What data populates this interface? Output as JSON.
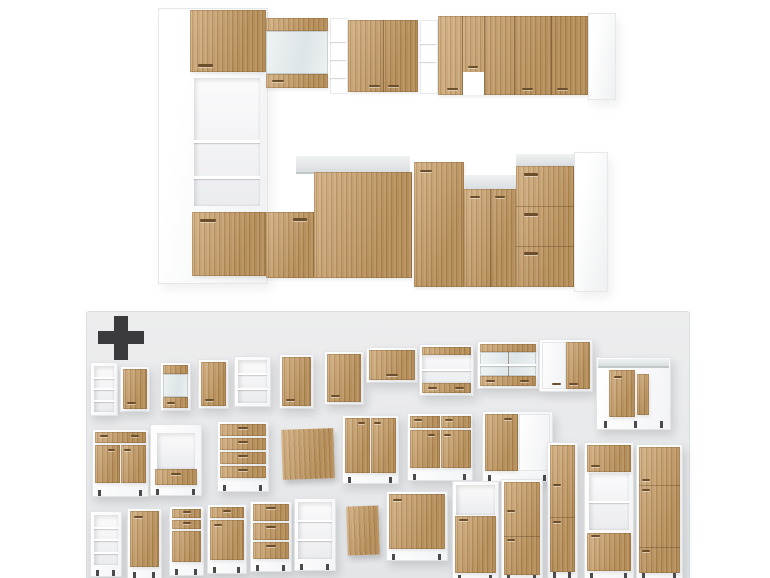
{
  "colors": {
    "background": "#ffffff",
    "panel_bg": "#e9ebee",
    "plus": "#3b3b3d",
    "wood_light": "#cfa977",
    "wood_dark": "#b2884f",
    "carcass_white": "#ffffff",
    "counter_gray": "#dfe3e4",
    "glass_tint": "#e8eef0",
    "handle": "#6b4f2c",
    "leg": "#4b4b4d"
  },
  "plus_icon": {
    "name": "plus-icon"
  },
  "assembled_kitchen": {
    "primitives": [
      {
        "name": "tall-cabinet-carcass",
        "cls": "carcass",
        "x": 158,
        "y": 8,
        "w": 108,
        "h": 274
      },
      {
        "name": "tall-cabinet-upper-door",
        "cls": "wood",
        "x": 190,
        "y": 10,
        "w": 76,
        "h": 62
      },
      {
        "name": "door-handle",
        "cls": "handle",
        "x": 198,
        "y": 64,
        "w": 15,
        "h": 3
      },
      {
        "name": "tall-cabinet-niche",
        "cls": "niche",
        "x": 194,
        "y": 78,
        "w": 66,
        "h": 128
      },
      {
        "name": "niche-shelf",
        "cls": "shelf",
        "x": 194,
        "y": 140,
        "w": 66,
        "h": 3
      },
      {
        "name": "niche-shelf",
        "cls": "shelf",
        "x": 194,
        "y": 176,
        "w": 66,
        "h": 3
      },
      {
        "name": "tall-cabinet-lower-front",
        "cls": "wood",
        "x": 192,
        "y": 212,
        "w": 74,
        "h": 64
      },
      {
        "name": "drawer-handle",
        "cls": "handle",
        "x": 200,
        "y": 219,
        "w": 16,
        "h": 3
      },
      {
        "name": "glass-wall-cabinet-top-strip",
        "cls": "wood",
        "x": 266,
        "y": 18,
        "w": 62,
        "h": 13
      },
      {
        "name": "glass-wall-cabinet-pane",
        "cls": "glass",
        "x": 266,
        "y": 31,
        "w": 62,
        "h": 43
      },
      {
        "name": "glass-wall-cabinet-bottom-strip",
        "cls": "wood",
        "x": 266,
        "y": 74,
        "w": 62,
        "h": 14
      },
      {
        "name": "door-handle",
        "cls": "handle",
        "x": 272,
        "y": 80,
        "w": 12,
        "h": 2
      },
      {
        "name": "open-shelf-column",
        "cls": "shelfcol",
        "x": 330,
        "y": 18,
        "w": 16,
        "h": 74
      },
      {
        "name": "shelf",
        "cls": "shelf",
        "x": 330,
        "y": 40,
        "w": 16,
        "h": 2
      },
      {
        "name": "shelf",
        "cls": "shelf",
        "x": 330,
        "y": 58,
        "w": 16,
        "h": 2
      },
      {
        "name": "shelf",
        "cls": "shelf",
        "x": 330,
        "y": 76,
        "w": 16,
        "h": 2
      },
      {
        "name": "wall-cabinet-double-door",
        "cls": "wood",
        "x": 348,
        "y": 20,
        "w": 70,
        "h": 72
      },
      {
        "name": "door-seam",
        "cls": "seam",
        "x": 383,
        "y": 20,
        "w": 1,
        "h": 72
      },
      {
        "name": "door-handle",
        "cls": "handle",
        "x": 369,
        "y": 85,
        "w": 11,
        "h": 2
      },
      {
        "name": "door-handle",
        "cls": "handle",
        "x": 388,
        "y": 85,
        "w": 11,
        "h": 2
      },
      {
        "name": "open-shelf-column",
        "cls": "shelfcol",
        "x": 420,
        "y": 20,
        "w": 16,
        "h": 72
      },
      {
        "name": "shelf",
        "cls": "shelf",
        "x": 420,
        "y": 42,
        "w": 16,
        "h": 2
      },
      {
        "name": "shelf",
        "cls": "shelf",
        "x": 420,
        "y": 60,
        "w": 16,
        "h": 2
      },
      {
        "name": "corner-wall-cabinet-run",
        "cls": "wood",
        "x": 438,
        "y": 16,
        "w": 150,
        "h": 79
      },
      {
        "name": "door-seam",
        "cls": "seam",
        "x": 462,
        "y": 16,
        "w": 1,
        "h": 79
      },
      {
        "name": "door-seam",
        "cls": "seam",
        "x": 484,
        "y": 16,
        "w": 1,
        "h": 79
      },
      {
        "name": "door-seam",
        "cls": "seam",
        "x": 514,
        "y": 16,
        "w": 1,
        "h": 79
      },
      {
        "name": "door-seam",
        "cls": "seam",
        "x": 551,
        "y": 16,
        "w": 1,
        "h": 79
      },
      {
        "name": "hood-recess",
        "cls": "gap",
        "x": 463,
        "y": 72,
        "w": 21,
        "h": 23
      },
      {
        "name": "door-handle",
        "cls": "handle",
        "x": 447,
        "y": 88,
        "w": 11,
        "h": 2
      },
      {
        "name": "door-handle",
        "cls": "handle",
        "x": 468,
        "y": 66,
        "w": 10,
        "h": 2
      },
      {
        "name": "door-handle",
        "cls": "handle",
        "x": 522,
        "y": 88,
        "w": 11,
        "h": 2
      },
      {
        "name": "door-handle",
        "cls": "handle",
        "x": 557,
        "y": 88,
        "w": 11,
        "h": 2
      },
      {
        "name": "wall-run-end-panel",
        "cls": "carcass",
        "x": 588,
        "y": 13,
        "w": 26,
        "h": 85
      },
      {
        "name": "left-base-cabinet-front",
        "cls": "wood",
        "x": 266,
        "y": 212,
        "w": 48,
        "h": 66
      },
      {
        "name": "drawer-handle",
        "cls": "handle",
        "x": 293,
        "y": 218,
        "w": 14,
        "h": 3
      },
      {
        "name": "corner-countertop",
        "cls": "counter",
        "x": 296,
        "y": 156,
        "w": 114,
        "h": 16
      },
      {
        "name": "corner-base-cabinet",
        "cls": "wood",
        "x": 314,
        "y": 172,
        "w": 98,
        "h": 106
      },
      {
        "name": "right-base-cabinet",
        "cls": "wood",
        "x": 414,
        "y": 162,
        "w": 50,
        "h": 125
      },
      {
        "name": "door-handle",
        "cls": "handle",
        "x": 420,
        "y": 170,
        "w": 12,
        "h": 2
      },
      {
        "name": "right-countertop",
        "cls": "counter",
        "x": 464,
        "y": 175,
        "w": 52,
        "h": 14
      },
      {
        "name": "right-base-cabinets",
        "cls": "wood",
        "x": 464,
        "y": 189,
        "w": 52,
        "h": 98
      },
      {
        "name": "door-seam",
        "cls": "seam",
        "x": 490,
        "y": 189,
        "w": 1,
        "h": 98
      },
      {
        "name": "door-handle",
        "cls": "handle",
        "x": 470,
        "y": 196,
        "w": 10,
        "h": 2
      },
      {
        "name": "door-handle",
        "cls": "handle",
        "x": 495,
        "y": 196,
        "w": 10,
        "h": 2
      },
      {
        "name": "drawer-unit-countertop",
        "cls": "counter",
        "x": 516,
        "y": 154,
        "w": 58,
        "h": 12
      },
      {
        "name": "drawer-base-unit",
        "cls": "wood",
        "x": 516,
        "y": 166,
        "w": 58,
        "h": 121
      },
      {
        "name": "drawer-seam",
        "cls": "seamh",
        "x": 516,
        "y": 206,
        "w": 58,
        "h": 1
      },
      {
        "name": "drawer-seam",
        "cls": "seamh",
        "x": 516,
        "y": 246,
        "w": 58,
        "h": 1
      },
      {
        "name": "drawer-handle",
        "cls": "handle",
        "x": 524,
        "y": 173,
        "w": 14,
        "h": 3
      },
      {
        "name": "drawer-handle",
        "cls": "handle",
        "x": 524,
        "y": 213,
        "w": 14,
        "h": 3
      },
      {
        "name": "drawer-handle",
        "cls": "handle",
        "x": 524,
        "y": 252,
        "w": 14,
        "h": 3
      },
      {
        "name": "base-run-end-panel",
        "cls": "carcass",
        "x": 574,
        "y": 152,
        "w": 32,
        "h": 138
      }
    ]
  },
  "module_panel": {
    "x": 86,
    "y": 311,
    "w": 602,
    "h": 267,
    "modules": [
      {
        "name": "wall-open-shelf-unit",
        "kind": "open-shelves",
        "x": 3,
        "y": 50,
        "w": 26,
        "h": 52,
        "shelves": 4
      },
      {
        "name": "wall-cabinet-door",
        "kind": "door",
        "x": 33,
        "y": 54,
        "w": 28,
        "h": 44
      },
      {
        "name": "wall-cabinet-glass",
        "kind": "glass",
        "x": 73,
        "y": 50,
        "w": 29,
        "h": 47
      },
      {
        "name": "wall-cabinet-door",
        "kind": "door",
        "x": 111,
        "y": 47,
        "w": 29,
        "h": 48
      },
      {
        "name": "wall-open-shelf-unit",
        "kind": "open-shelves",
        "x": 147,
        "y": 44,
        "w": 35,
        "h": 49,
        "shelves": 3
      },
      {
        "name": "wall-cabinet-door",
        "kind": "door",
        "x": 192,
        "y": 42,
        "w": 33,
        "h": 53
      },
      {
        "name": "wall-cabinet-door",
        "kind": "door",
        "x": 237,
        "y": 39,
        "w": 38,
        "h": 52
      },
      {
        "name": "hood-wall-cabinet",
        "kind": "door-wide",
        "x": 279,
        "y": 35,
        "w": 50,
        "h": 34
      },
      {
        "name": "wall-cabinet-open-wide",
        "kind": "glass-wide-open",
        "x": 332,
        "y": 32,
        "w": 53,
        "h": 50
      },
      {
        "name": "wall-cabinet-glass-wide",
        "kind": "glass-wide",
        "x": 390,
        "y": 29,
        "w": 60,
        "h": 46
      },
      {
        "name": "wall-cabinet-mixed-doors",
        "kind": "two-door-mixed",
        "x": 452,
        "y": 27,
        "w": 52,
        "h": 51
      },
      {
        "name": "corner-base-cabinet",
        "kind": "corner-base",
        "x": 509,
        "y": 45,
        "w": 73,
        "h": 71
      },
      {
        "name": "base-cabinet-drawer-two-doors",
        "kind": "base-2door-drawer",
        "x": 5,
        "y": 117,
        "w": 55,
        "h": 66
      },
      {
        "name": "oven-housing-cabinet",
        "kind": "oven-base",
        "x": 63,
        "y": 112,
        "w": 50,
        "h": 70
      },
      {
        "name": "drawer-base-cabinet",
        "kind": "base-drawers",
        "x": 130,
        "y": 109,
        "w": 50,
        "h": 69,
        "drawers": 4
      },
      {
        "name": "appliance-front-panel",
        "kind": "panel",
        "x": 195,
        "y": 117,
        "w": 52,
        "h": 50
      },
      {
        "name": "base-cabinet-two-doors",
        "kind": "base-2door",
        "x": 255,
        "y": 103,
        "w": 55,
        "h": 67
      },
      {
        "name": "base-cabinet-two-doors-two-drawers",
        "kind": "base-2door-2drawer",
        "x": 320,
        "y": 101,
        "w": 64,
        "h": 66
      },
      {
        "name": "base-cabinet-mixed-doors",
        "kind": "base-2door-mixed",
        "x": 395,
        "y": 99,
        "w": 69,
        "h": 69
      },
      {
        "name": "tall-pantry-cabinet",
        "kind": "tall-pantry",
        "x": 460,
        "y": 130,
        "w": 29,
        "h": 135
      },
      {
        "name": "tall-oven-housing",
        "kind": "tall-oven",
        "x": 497,
        "y": 130,
        "w": 48,
        "h": 136
      },
      {
        "name": "tall-fridge-housing",
        "kind": "tall-fridge",
        "x": 549,
        "y": 132,
        "w": 45,
        "h": 134
      },
      {
        "name": "open-shelf-base-unit",
        "kind": "open-shelves-base",
        "x": 3,
        "y": 199,
        "w": 30,
        "h": 64,
        "shelves": 4
      },
      {
        "name": "base-cabinet-door",
        "kind": "base-door",
        "x": 40,
        "y": 196,
        "w": 33,
        "h": 69
      },
      {
        "name": "base-cabinet-two-drawers-door",
        "kind": "base-2drawer-door",
        "x": 82,
        "y": 194,
        "w": 33,
        "h": 68
      },
      {
        "name": "base-cabinet-drawer-door",
        "kind": "base-drawer-door",
        "x": 120,
        "y": 192,
        "w": 38,
        "h": 68
      },
      {
        "name": "drawer-base-cabinet",
        "kind": "base-drawers",
        "x": 163,
        "y": 189,
        "w": 40,
        "h": 69,
        "drawers": 3
      },
      {
        "name": "open-shelf-base-unit",
        "kind": "open-shelves-base",
        "x": 207,
        "y": 186,
        "w": 40,
        "h": 71,
        "shelves": 3
      },
      {
        "name": "side-panel",
        "kind": "panel",
        "x": 260,
        "y": 194,
        "w": 32,
        "h": 49
      },
      {
        "name": "base-cabinet-door-wide",
        "kind": "base-door",
        "x": 299,
        "y": 179,
        "w": 60,
        "h": 68
      },
      {
        "name": "tall-microwave-cabinet",
        "kind": "tall-microwave",
        "x": 365,
        "y": 169,
        "w": 45,
        "h": 99
      },
      {
        "name": "tall-pantry-cabinet",
        "kind": "tall-pantry",
        "x": 414,
        "y": 167,
        "w": 40,
        "h": 101
      }
    ]
  }
}
